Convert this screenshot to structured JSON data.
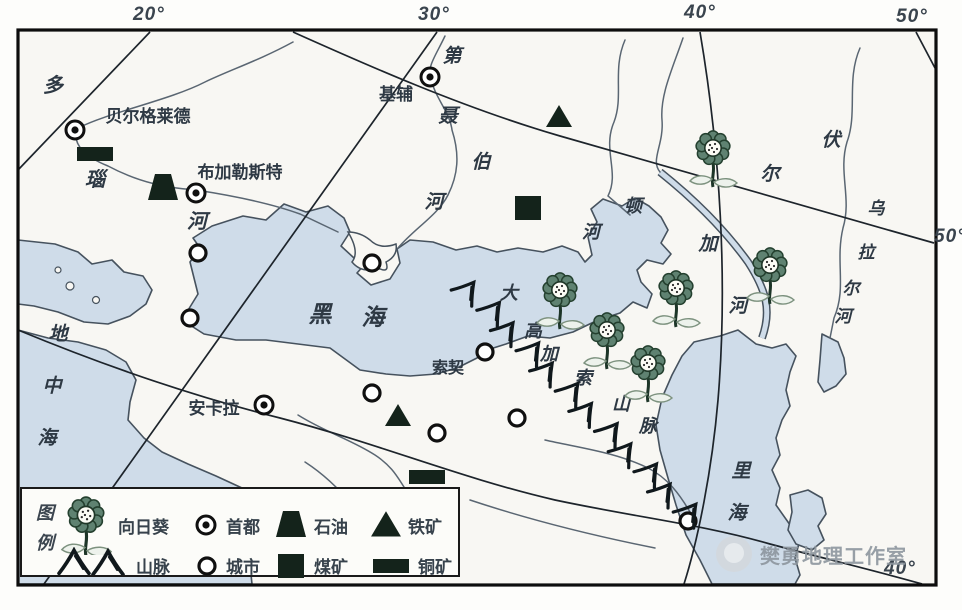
{
  "graticule": {
    "top_labels": [
      {
        "text": "20°",
        "x": 133,
        "y": 4
      },
      {
        "text": "30°",
        "x": 418,
        "y": 4
      },
      {
        "text": "40°",
        "x": 684,
        "y": 2
      },
      {
        "text": "50°",
        "x": 896,
        "y": 6
      }
    ],
    "right_label": {
      "text": "50°",
      "x": 934,
      "y": 226
    },
    "bottom_label": {
      "text": "40°",
      "x": 884,
      "y": 560
    }
  },
  "legend": {
    "title": "图例",
    "items": [
      {
        "icon": "sunflower",
        "label": "向日葵"
      },
      {
        "icon": "capital",
        "label": "首都"
      },
      {
        "icon": "oil",
        "label": "石油"
      },
      {
        "icon": "iron",
        "label": "铁矿"
      },
      {
        "icon": "mountains",
        "label": "山脉"
      },
      {
        "icon": "city",
        "label": "城市"
      },
      {
        "icon": "coal",
        "label": "煤矿"
      },
      {
        "icon": "copper",
        "label": "铜矿"
      }
    ]
  },
  "watermark": {
    "text": "樊勇地理工作室"
  },
  "map": {
    "labels": [
      {
        "name": "danube-river-label",
        "size": 20,
        "italic": true,
        "chars": [
          {
            "c": "多",
            "x": 53,
            "y": 92
          },
          {
            "c": "瑙",
            "x": 95,
            "y": 186
          },
          {
            "c": "河",
            "x": 197,
            "y": 228
          }
        ]
      },
      {
        "name": "belgrade-label",
        "size": 17,
        "text": "贝尔格莱德",
        "x": 148,
        "y": 122
      },
      {
        "name": "bucharest-label",
        "size": 17,
        "text": "布加勒斯特",
        "x": 240,
        "y": 178
      },
      {
        "name": "kyiv-label",
        "size": 17,
        "text": "基辅",
        "x": 396,
        "y": 100
      },
      {
        "name": "dnieper-river-label",
        "size": 19,
        "italic": true,
        "chars": [
          {
            "c": "第",
            "x": 452,
            "y": 62
          },
          {
            "c": "聂",
            "x": 448,
            "y": 122
          },
          {
            "c": "伯",
            "x": 481,
            "y": 168
          },
          {
            "c": "河",
            "x": 434,
            "y": 208
          }
        ]
      },
      {
        "name": "don-river-label",
        "size": 18,
        "italic": true,
        "chars": [
          {
            "c": "顿",
            "x": 633,
            "y": 212
          },
          {
            "c": "河",
            "x": 591,
            "y": 238
          }
        ]
      },
      {
        "name": "volga-river-label",
        "size": 19,
        "italic": true,
        "chars": [
          {
            "c": "伏",
            "x": 831,
            "y": 146
          },
          {
            "c": "尔",
            "x": 770,
            "y": 180
          },
          {
            "c": "加",
            "x": 708,
            "y": 250
          },
          {
            "c": "河",
            "x": 738,
            "y": 312
          }
        ]
      },
      {
        "name": "ural-river-label",
        "size": 17,
        "italic": true,
        "chars": [
          {
            "c": "乌",
            "x": 876,
            "y": 214
          },
          {
            "c": "拉",
            "x": 866,
            "y": 258
          },
          {
            "c": "尔",
            "x": 851,
            "y": 294
          },
          {
            "c": "河",
            "x": 843,
            "y": 322
          }
        ]
      },
      {
        "name": "black-sea-label",
        "size": 23,
        "italic": true,
        "chars": [
          {
            "c": "黑",
            "x": 320,
            "y": 322
          },
          {
            "c": "海",
            "x": 373,
            "y": 325
          }
        ]
      },
      {
        "name": "mediterranean-sea-label",
        "size": 19,
        "italic": true,
        "chars": [
          {
            "c": "地",
            "x": 58,
            "y": 340
          },
          {
            "c": "中",
            "x": 52,
            "y": 392
          },
          {
            "c": "海",
            "x": 47,
            "y": 444
          }
        ]
      },
      {
        "name": "caspian-sea-label",
        "size": 19,
        "italic": true,
        "chars": [
          {
            "c": "里",
            "x": 741,
            "y": 477
          },
          {
            "c": "海",
            "x": 737,
            "y": 519
          }
        ]
      },
      {
        "name": "sochi-label",
        "size": 16,
        "text": "索契",
        "x": 448,
        "y": 373
      },
      {
        "name": "ankara-label",
        "size": 17,
        "text": "安卡拉",
        "x": 214,
        "y": 414
      },
      {
        "name": "caucasus-mountains-label",
        "size": 18,
        "italic": true,
        "chars": [
          {
            "c": "大",
            "x": 509,
            "y": 299
          },
          {
            "c": "高",
            "x": 533,
            "y": 337
          },
          {
            "c": "加",
            "x": 549,
            "y": 360
          },
          {
            "c": "索",
            "x": 583,
            "y": 384
          },
          {
            "c": "山",
            "x": 621,
            "y": 410
          },
          {
            "c": "脉",
            "x": 648,
            "y": 432
          }
        ]
      }
    ],
    "sunflowers": [
      {
        "x": 713,
        "y": 148
      },
      {
        "x": 770,
        "y": 265
      },
      {
        "x": 676,
        "y": 288
      },
      {
        "x": 560,
        "y": 290
      },
      {
        "x": 607,
        "y": 330
      },
      {
        "x": 648,
        "y": 363
      }
    ],
    "capitals": [
      {
        "x": 75,
        "y": 130,
        "name": "belgrade"
      },
      {
        "x": 196,
        "y": 193,
        "name": "bucharest"
      },
      {
        "x": 430,
        "y": 77,
        "name": "kyiv"
      },
      {
        "x": 264,
        "y": 405,
        "name": "ankara"
      }
    ],
    "cities": [
      {
        "x": 198,
        "y": 253
      },
      {
        "x": 190,
        "y": 318
      },
      {
        "x": 372,
        "y": 263
      },
      {
        "x": 372,
        "y": 393
      },
      {
        "x": 437,
        "y": 433
      },
      {
        "x": 485,
        "y": 352
      },
      {
        "x": 517,
        "y": 418
      },
      {
        "x": 688,
        "y": 521
      }
    ],
    "iron_ore": [
      {
        "x": 559,
        "y": 117
      },
      {
        "x": 398,
        "y": 416
      }
    ],
    "oil": [
      {
        "x": 163,
        "y": 187
      }
    ],
    "coal": [
      {
        "x": 528,
        "y": 208
      }
    ],
    "copper": [
      {
        "x": 95,
        "y": 154
      },
      {
        "x": 427,
        "y": 477
      }
    ],
    "mountain_chain": {
      "points": [
        [
          470,
          291
        ],
        [
          562,
          386
        ],
        [
          686,
          513
        ]
      ],
      "count": 12,
      "rotation": 38
    }
  }
}
